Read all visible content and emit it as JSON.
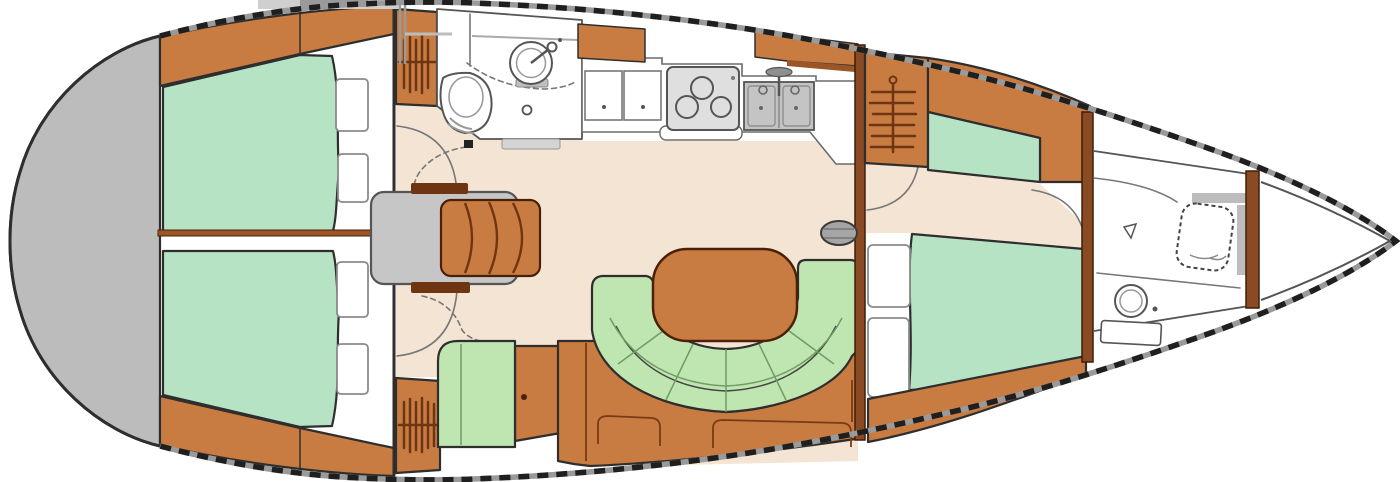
{
  "labels": {
    "boat": "sailboat interior floor plan, bow right, stern left",
    "stern_platform": "stern transom platform",
    "aft_cabin_port": "aft cabin berth (top)",
    "aft_cabin_starboard": "aft cabin berth (bottom)",
    "aft_head": "aft head with toilet and sink",
    "companionway": "companionway steps and engine box",
    "hanging_locker": "hanging locker",
    "nav_station": "chart table and seat",
    "galley": "galley with lockers, stove and twin sink",
    "salon": "salon U-settee with table",
    "mast": "mast step",
    "main_bulkhead": "main bulkhead",
    "forward_cabin": "forward cabin V-berth",
    "forward_head": "forward head with toilet and sink",
    "bow": "bow with anchor locker",
    "deck_hatch": "companionway sliding hatch"
  },
  "colors": {
    "outline": "#2e2e2e",
    "line_gray": "#777777",
    "rail_gray": "#9a9a9a",
    "rail_dash": "#1f1f1f",
    "transom_gray": "#bcbcbc",
    "wood": "#c97c42",
    "wood_dark": "#6e3512",
    "wood_shelf": "#9c5527",
    "bulkhead_brown": "#8a4a23",
    "berth_green": "#b7e3c5",
    "settee_green": "#bfe5b0",
    "seam_green": "#6f9c64",
    "floor_beige": "#f4e4d3",
    "box_gray": "#c6c6c6",
    "appliance_gray": "#dfdfdf",
    "sink_gray": "#c4c4c4",
    "mast_gray": "#a5a5a5",
    "threshold_gray": "#d4d4d4",
    "fixture_line": "#555555",
    "white": "#ffffff"
  }
}
